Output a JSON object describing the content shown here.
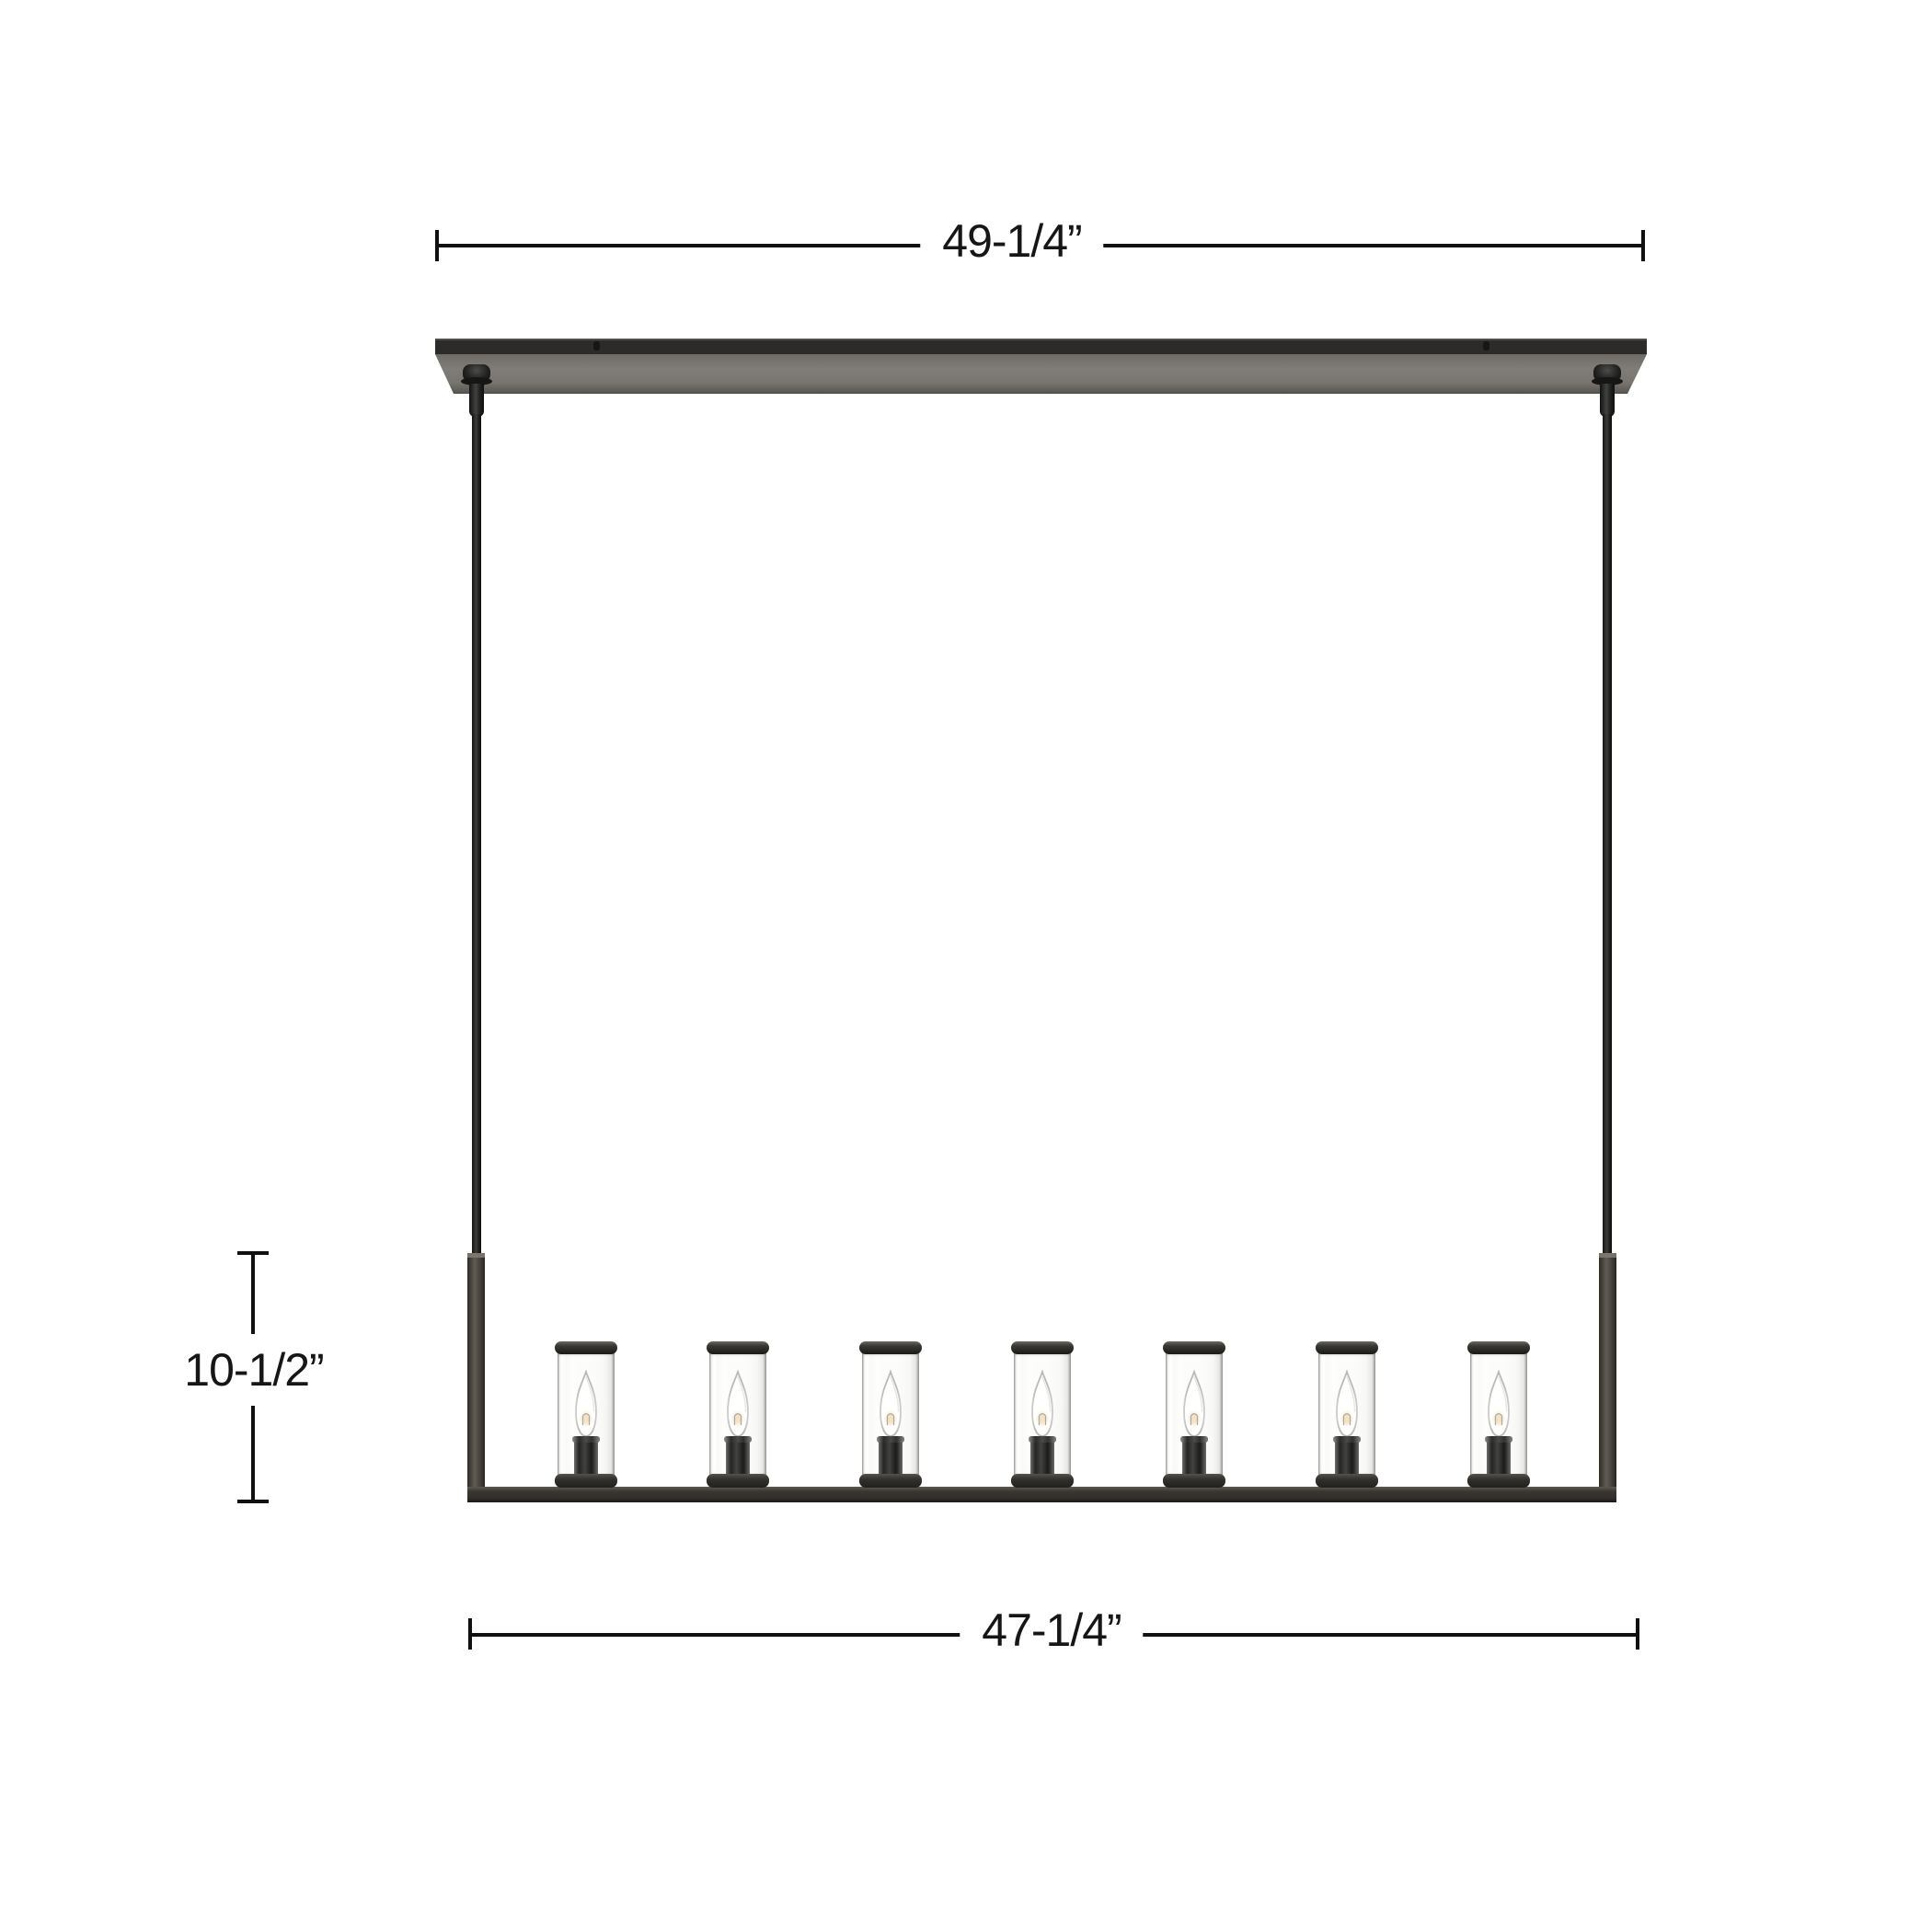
{
  "diagram": {
    "subject": "7-light linear chandelier with clear cylinder glass shades, dimension drawing",
    "lights_count": 7,
    "dimension_labels": {
      "overall_length": "49-1/4”",
      "body_drop": "10-1/2”",
      "frame_length": "47-1/4”"
    },
    "colors": {
      "dimension_line": "#101010",
      "canopy_top": "#2c2b29",
      "canopy_underside": "#7a7671",
      "frame_metal": "#4a463f",
      "glass": "#fcfcfb",
      "bulb_glow": "#f2d2a2"
    }
  }
}
